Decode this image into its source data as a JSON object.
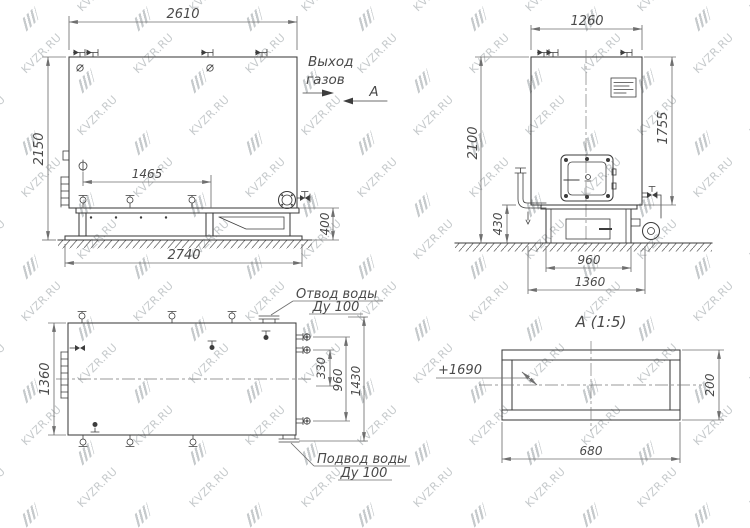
{
  "watermark": {
    "text": "KVZR.RU"
  },
  "side_view": {
    "dim_width_top": "2610",
    "dim_height": "2150",
    "dim_nozzles": "1465",
    "dim_base_height": "400",
    "dim_width_bottom": "2740",
    "label_gas_out_1": "Выход",
    "label_gas_out_2": "газов",
    "section_mark": "А"
  },
  "front_view": {
    "dim_width_top": "1260",
    "dim_height_total": "2100",
    "dim_height_body": "1755",
    "dim_pipe_height": "430",
    "dim_base_width": "960",
    "dim_frame_width": "1360"
  },
  "plan_view": {
    "dim_depth": "1360",
    "dim_right_330": "330",
    "dim_right_960": "960",
    "dim_right_1430": "1430",
    "label_outlet_1": "Отвод воды",
    "label_outlet_2": "Ду 100",
    "label_inlet_1": "Подвод воды",
    "label_inlet_2": "Ду 100"
  },
  "detail_a": {
    "title": "А  (1:5)",
    "dim_width": "680",
    "dim_height": "200",
    "level_mark": "+1690"
  }
}
